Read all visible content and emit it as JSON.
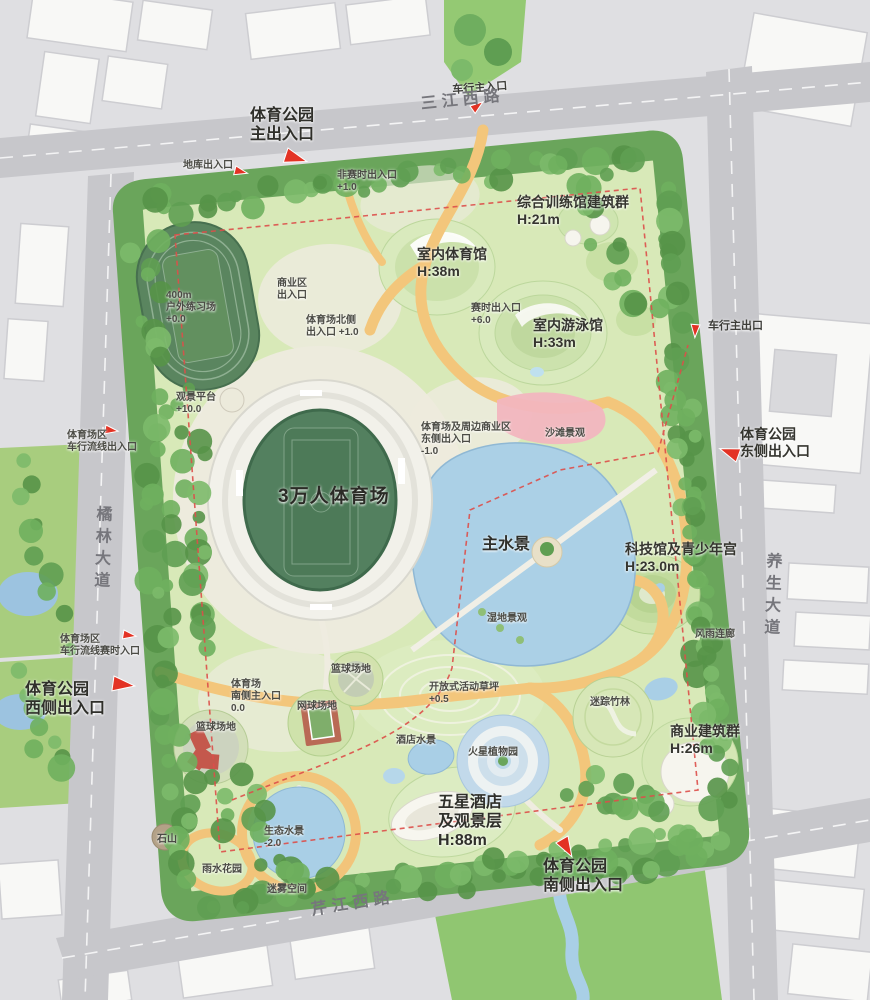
{
  "roads": {
    "north": "三江西路",
    "west": "橘林大道",
    "east": "养生大道",
    "south": "芹江西路"
  },
  "labels": [
    {
      "text": "体育公园\n主出入口"
    },
    {
      "text": "车行主入口"
    },
    {
      "text": "地库出入口"
    },
    {
      "text": "非赛时出入口\n+1.0"
    },
    {
      "text": "综合训练馆建筑群\nH:21m"
    },
    {
      "text": "室内体育馆\nH:38m"
    },
    {
      "text": "400m\n户外练习场\n+0.0"
    },
    {
      "text": "商业区\n出入口"
    },
    {
      "text": "体育场北侧\n出入口 +1.0"
    },
    {
      "text": "赛时出入口\n+6.0"
    },
    {
      "text": "室内游泳馆\nH:33m"
    },
    {
      "text": "车行主出口"
    },
    {
      "text": "体育公园\n东侧出入口"
    },
    {
      "text": "观景平台\n+10.0"
    },
    {
      "text": "体育场区\n车行流线出入口"
    },
    {
      "text": "体育场及周边商业区\n东侧出入口\n-1.0"
    },
    {
      "text": "沙滩景观"
    },
    {
      "text": "3万人体育场"
    },
    {
      "text": "主水景"
    },
    {
      "text": "科技馆及青少年宫\nH:23.0m"
    },
    {
      "text": "湿地景观"
    },
    {
      "text": "风雨连廊"
    },
    {
      "text": "体育场区\n车行流线赛时入口"
    },
    {
      "text": "体育公园\n西侧出入口"
    },
    {
      "text": "体育场\n南侧主入口\n0.0"
    },
    {
      "text": "篮球场地"
    },
    {
      "text": "网球场地"
    },
    {
      "text": "篮球场地"
    },
    {
      "text": "开放式活动草坪\n+0.5"
    },
    {
      "text": "迷踪竹林"
    },
    {
      "text": "商业建筑群\nH:26m"
    },
    {
      "text": "酒店水景"
    },
    {
      "text": "火星植物园"
    },
    {
      "text": "五星酒店\n及观景层\nH:88m"
    },
    {
      "text": "石山"
    },
    {
      "text": "生态水景\n-2.0"
    },
    {
      "text": "雨水花园"
    },
    {
      "text": "迷雾空间"
    },
    {
      "text": "体育公园\n南侧出入口"
    }
  ],
  "colors": {
    "road_gray": "#c7c7cb",
    "block_gray": "#e2e2e5",
    "building_white": "#f8f8f6",
    "park_lawn": "#d8e9b8",
    "tree_green": "#5f9e52",
    "water_blue": "#abd0e6",
    "path_orange": "#f3c67b",
    "beach_pink": "#f2b6bf",
    "stadium_field": "#4d7a58",
    "boundary_red": "#dd4f4a",
    "arrow_red": "#e33224"
  }
}
